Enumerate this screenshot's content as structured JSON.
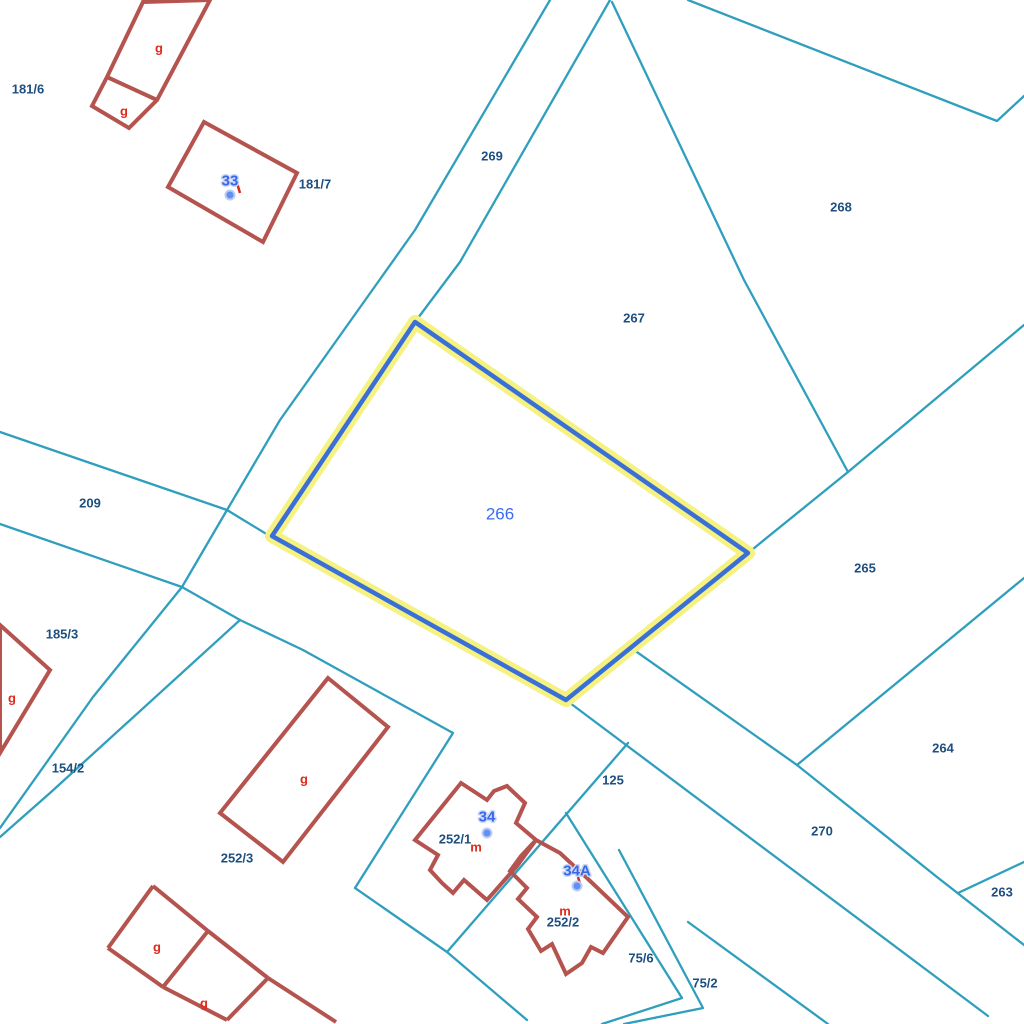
{
  "map": {
    "type": "cadastral-parcel-map",
    "background": "#ffffff",
    "colors": {
      "boundary": "#2f9fbd",
      "building": "#b5534f",
      "building_label": "#e02a1c",
      "parcel_label": "#1e4f80",
      "house_number": "#3a66e8",
      "house_number_halo": "#c9d9f7",
      "house_dot": "#638ff2",
      "house_dot_ring": "#b8ccf5",
      "highlight_halo": "#f5f282",
      "highlight_core": "#3a6fd8",
      "selected_label": "#3a6cf0",
      "tick": "#d92b1f"
    },
    "selected_parcel": {
      "id": "266",
      "points": [
        [
          415,
          322
        ],
        [
          748,
          553
        ],
        [
          566,
          700
        ],
        [
          272,
          536
        ]
      ],
      "label": {
        "text": "266",
        "x": 500,
        "y": 514
      }
    },
    "boundary_lines": [
      [
        [
          550,
          0
        ],
        [
          415,
          230
        ],
        [
          280,
          420
        ],
        [
          227,
          510
        ],
        [
          182,
          587
        ],
        [
          93,
          697
        ],
        [
          0,
          828
        ]
      ],
      [
        [
          610,
          0
        ],
        [
          460,
          262
        ],
        [
          415,
          322
        ]
      ],
      [
        [
          612,
          2
        ],
        [
          744,
          280
        ],
        [
          848,
          472
        ]
      ],
      [
        [
          688,
          0
        ],
        [
          997,
          121
        ],
        [
          1024,
          96
        ]
      ],
      [
        [
          1024,
          325
        ],
        [
          848,
          472
        ],
        [
          748,
          553
        ]
      ],
      [
        [
          1024,
          578
        ],
        [
          797,
          765
        ],
        [
          937,
          877
        ],
        [
          1024,
          945
        ]
      ],
      [
        [
          634,
          650
        ],
        [
          797,
          765
        ]
      ],
      [
        [
          566,
          700
        ],
        [
          988,
          1016
        ]
      ],
      [
        [
          0,
          432
        ],
        [
          227,
          510
        ],
        [
          268,
          535
        ]
      ],
      [
        [
          0,
          524
        ],
        [
          182,
          587
        ],
        [
          240,
          620
        ],
        [
          303,
          650
        ],
        [
          453,
          733
        ],
        [
          355,
          888
        ],
        [
          447,
          952
        ],
        [
          527,
          1020
        ]
      ],
      [
        [
          447,
          952
        ],
        [
          628,
          743
        ]
      ],
      [
        [
          240,
          620
        ],
        [
          50,
          793
        ],
        [
          0,
          837
        ]
      ],
      [
        [
          566,
          813
        ],
        [
          682,
          998
        ],
        [
          602,
          1024
        ]
      ],
      [
        [
          619,
          850
        ],
        [
          703,
          1008
        ],
        [
          624,
          1024
        ]
      ],
      [
        [
          688,
          922
        ],
        [
          828,
          1024
        ]
      ],
      [
        [
          958,
          893
        ],
        [
          1024,
          862
        ]
      ]
    ],
    "buildings": {
      "polygons": [
        [
          [
            143,
            2
          ],
          [
            210,
            0
          ],
          [
            157,
            100
          ],
          [
            129,
            128
          ],
          [
            92,
            106
          ],
          [
            107,
            77
          ]
        ],
        [
          [
            204,
            122
          ],
          [
            297,
            173
          ],
          [
            263,
            242
          ],
          [
            168,
            187
          ]
        ],
        [
          [
            0,
            625
          ],
          [
            50,
            670
          ],
          [
            0,
            753
          ]
        ],
        [
          [
            328,
            678
          ],
          [
            388,
            727
          ],
          [
            283,
            862
          ],
          [
            220,
            813
          ]
        ],
        [
          [
            461,
            783
          ],
          [
            487,
            800
          ],
          [
            494,
            791
          ],
          [
            507,
            786
          ],
          [
            525,
            803
          ],
          [
            516,
            823
          ],
          [
            536,
            840
          ],
          [
            517,
            866
          ],
          [
            487,
            900
          ],
          [
            464,
            880
          ],
          [
            453,
            893
          ],
          [
            442,
            883
          ],
          [
            430,
            870
          ],
          [
            438,
            855
          ],
          [
            415,
            840
          ]
        ],
        [
          [
            536,
            840
          ],
          [
            560,
            853
          ],
          [
            588,
            879
          ],
          [
            628,
            917
          ],
          [
            603,
            953
          ],
          [
            591,
            947
          ],
          [
            582,
            963
          ],
          [
            566,
            974
          ],
          [
            552,
            944
          ],
          [
            541,
            951
          ],
          [
            528,
            929
          ],
          [
            537,
            917
          ],
          [
            518,
            899
          ],
          [
            527,
            888
          ],
          [
            510,
            871
          ],
          [
            521,
            856
          ]
        ]
      ],
      "walls": [
        [
          107,
          77,
          157,
          100
        ],
        [
          108,
          948,
          153,
          886
        ],
        [
          153,
          886,
          208,
          931
        ],
        [
          208,
          931,
          268,
          978
        ],
        [
          268,
          978,
          336,
          1022
        ],
        [
          108,
          948,
          163,
          987
        ],
        [
          163,
          987,
          227,
          1020
        ],
        [
          227,
          1020,
          268,
          978
        ],
        [
          208,
          931,
          163,
          987
        ]
      ]
    },
    "parcel_labels": [
      {
        "text": "181/6",
        "x": 28,
        "y": 89
      },
      {
        "text": "181/7",
        "x": 315,
        "y": 184
      },
      {
        "text": "269",
        "x": 492,
        "y": 156
      },
      {
        "text": "268",
        "x": 841,
        "y": 207
      },
      {
        "text": "267",
        "x": 634,
        "y": 318
      },
      {
        "text": "209",
        "x": 90,
        "y": 503
      },
      {
        "text": "265",
        "x": 865,
        "y": 568
      },
      {
        "text": "185/3",
        "x": 62,
        "y": 634
      },
      {
        "text": "154/2",
        "x": 68,
        "y": 768
      },
      {
        "text": "252/3",
        "x": 237,
        "y": 858
      },
      {
        "text": "125",
        "x": 613,
        "y": 780
      },
      {
        "text": "252/1",
        "x": 455,
        "y": 839
      },
      {
        "text": "252/2",
        "x": 563,
        "y": 922
      },
      {
        "text": "270",
        "x": 822,
        "y": 831
      },
      {
        "text": "264",
        "x": 943,
        "y": 748
      },
      {
        "text": "263",
        "x": 1002,
        "y": 892
      },
      {
        "text": "75/6",
        "x": 641,
        "y": 958
      },
      {
        "text": "75/2",
        "x": 705,
        "y": 983
      }
    ],
    "building_labels": [
      {
        "text": "g",
        "x": 159,
        "y": 48
      },
      {
        "text": "g",
        "x": 124,
        "y": 111
      },
      {
        "text": "g",
        "x": 12,
        "y": 698
      },
      {
        "text": "g",
        "x": 304,
        "y": 779
      },
      {
        "text": "m",
        "x": 476,
        "y": 847
      },
      {
        "text": "m",
        "x": 565,
        "y": 911
      },
      {
        "text": "g",
        "x": 157,
        "y": 947
      },
      {
        "text": "g",
        "x": 204,
        "y": 1003
      }
    ],
    "house_numbers": [
      {
        "text": "33",
        "x": 230,
        "y": 181,
        "dot_x": 230,
        "dot_y": 195
      },
      {
        "text": "34",
        "x": 487,
        "y": 817,
        "dot_x": 487,
        "dot_y": 833
      },
      {
        "text": "34A",
        "x": 577,
        "y": 871,
        "dot_x": 577,
        "dot_y": 886
      }
    ],
    "ticks": [
      [
        237,
        183,
        240,
        193
      ],
      [
        578,
        877,
        581,
        887
      ]
    ]
  }
}
